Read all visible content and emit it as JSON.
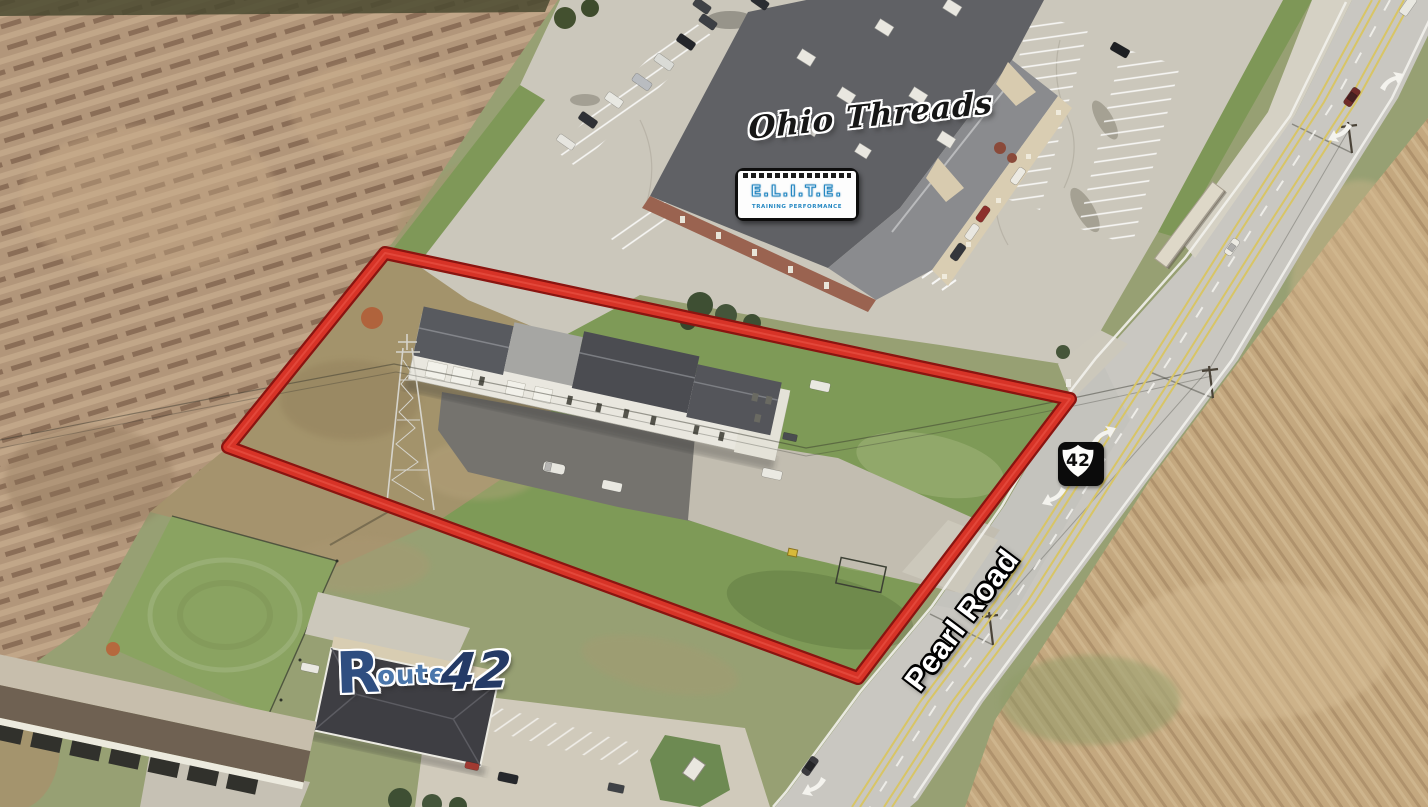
{
  "annotations": {
    "ohio_threads_label": "Ohio Threads",
    "elite_logo": {
      "title": "E.L.I.T.E.",
      "subtitle": "TRAINING PERFORMANCE"
    },
    "route_shield": {
      "number": "42"
    },
    "pearl_road_label": "Pearl Road",
    "route42_logo": {
      "letter_r": "R",
      "oute": "oute",
      "number": "42"
    }
  },
  "colors": {
    "property_outline_red": "#d73327",
    "property_outline_border": "#8a1410",
    "elite_blue": "#2387c2",
    "route42_navy": "#243a66",
    "road_gray": "#c9c7c1",
    "field_tan": "#b2967a",
    "corn_field_tan": "#c4a87f",
    "grass_green": "#8aa361",
    "roof_dark_gray": "#4b4c51"
  },
  "icons": {
    "us_route_shield": "us-route-shield",
    "turn_arrow": "white-curved-road-arrow"
  }
}
